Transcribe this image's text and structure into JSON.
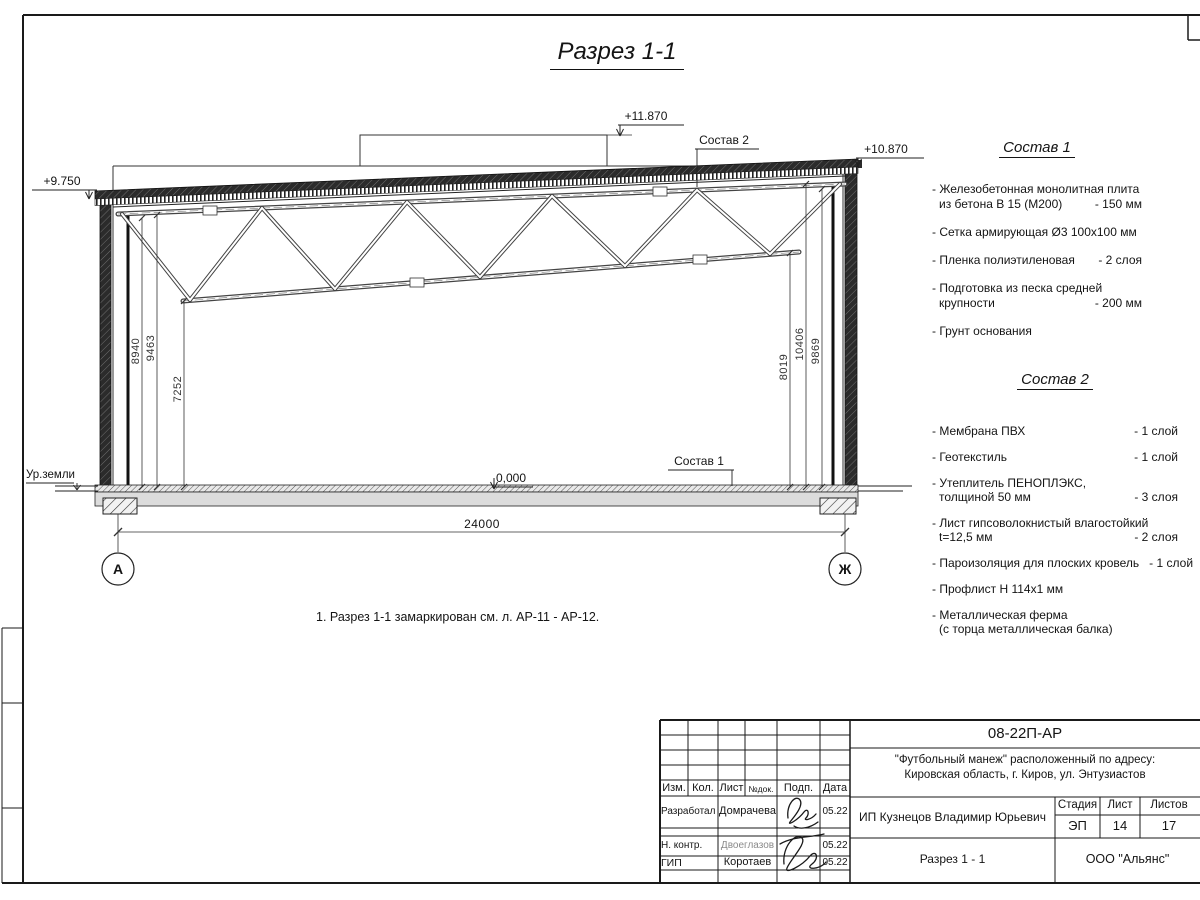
{
  "sheet": {
    "title": "Разрез 1-1",
    "note": "1. Разрез 1-1 замаркирован см. л. АР-11 - АР-12."
  },
  "drawing": {
    "elevations": {
      "parapet": "+11.870",
      "roof_right": "+10.870",
      "roof_left": "+9.750",
      "floor": "0,000"
    },
    "ground_label": "Ур.земли",
    "callout_sostav1": "Состав 1",
    "callout_sostav2": "Состав 2",
    "axis_left": "А",
    "axis_right": "Ж",
    "dim_span": "24000",
    "dims_left": [
      "8940",
      "9463",
      "7252"
    ],
    "dims_right": [
      "8019",
      "10406",
      "9869"
    ]
  },
  "sostav1": {
    "heading": "Состав 1",
    "items": [
      {
        "lines": [
          {
            "t": "- Железобетонная  монолитная плита"
          },
          {
            "t": "из бетона В 15 (М200)",
            "v": "- 150 мм"
          }
        ]
      },
      {
        "lines": [
          {
            "t": "- Сетка армирующая Ø3 100x100 мм"
          }
        ]
      },
      {
        "lines": [
          {
            "t": "- Пленка полиэтиленовая",
            "v": "- 2 слоя"
          }
        ]
      },
      {
        "lines": [
          {
            "t": "- Подготовка из песка средней"
          },
          {
            "t": "крупности",
            "v": "- 200 мм"
          }
        ]
      },
      {
        "lines": [
          {
            "t": "- Грунт основания"
          }
        ]
      }
    ]
  },
  "sostav2": {
    "heading": "Состав 2",
    "items": [
      {
        "lines": [
          {
            "t": "- Мембрана ПВХ",
            "v": "- 1 слой"
          }
        ]
      },
      {
        "lines": [
          {
            "t": "- Геотекстиль",
            "v": "- 1 слой"
          }
        ]
      },
      {
        "lines": [
          {
            "t": "- Утеплитель ПЕНОПЛЭКС,"
          },
          {
            "t": "толщиной 50 мм",
            "v": "- 3 слоя"
          }
        ]
      },
      {
        "lines": [
          {
            "t": "- Лист гипсоволокнистый влагостойкий"
          },
          {
            "t": "t=12,5 мм",
            "v": "- 2 слоя"
          }
        ]
      },
      {
        "lines": [
          {
            "t": "- Пароизоляция для плоских кровель",
            "v": "- 1 слой"
          }
        ]
      },
      {
        "lines": [
          {
            "t": "- Профлист Н 114x1 мм"
          }
        ]
      },
      {
        "lines": [
          {
            "t": "- Металлическая ферма"
          },
          {
            "t": "(с торца металлическая балка)"
          }
        ]
      }
    ]
  },
  "stamp": {
    "doc_number": "08-22П-АР",
    "project_line1": "\"Футбольный манеж\" расположенный по адресу:",
    "project_line2": "Кировская область, г. Киров, ул. Энтузиастов",
    "client": "ИП Кузнецов Владимир Юрьевич",
    "sheet_title": "Разрез 1 - 1",
    "company": "ООО \"Альянс\"",
    "header": [
      "Изм.",
      "Кол.",
      "Лист",
      "№док.",
      "Подп.",
      "Дата"
    ],
    "stage_label": "Стадия",
    "sheet_label": "Лист",
    "sheets_label": "Листов",
    "stage": "ЭП",
    "sheet_no": "14",
    "sheets_total": "17",
    "rows": [
      {
        "role": "Разработал",
        "name": "Домрачева",
        "date": "05.22"
      },
      {
        "role": "Н. контр.",
        "name": "Двоеглазов",
        "date": "05.22"
      },
      {
        "role": "ГИП",
        "name": "Коротаев",
        "date": "05.22"
      }
    ]
  }
}
